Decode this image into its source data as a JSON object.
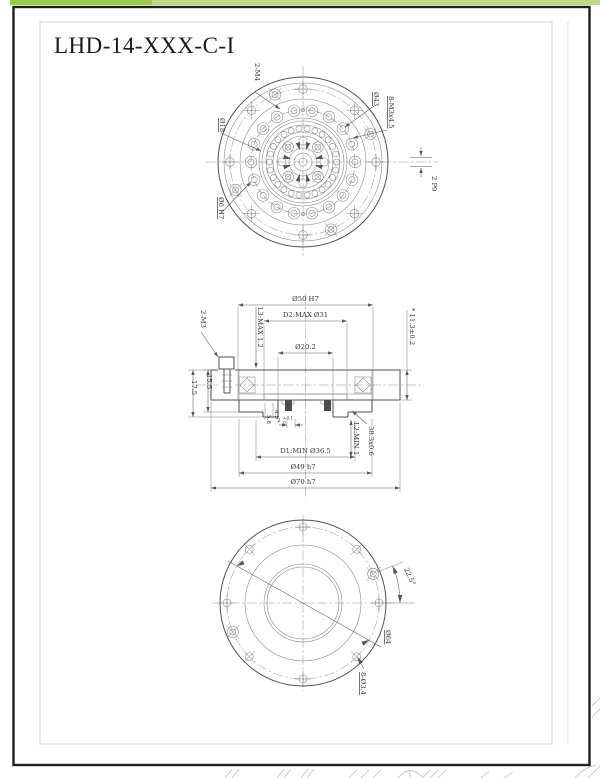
{
  "title": "LHD-14-XXX-C-I",
  "labels": {
    "tv_m4": "2-M4",
    "tv_d18": "Ø18",
    "tv_d6h7": "Ø6 H7",
    "tv_d43": "Ø43",
    "tv_m3x": "8-M3x4.5",
    "tv_key": "2 P9",
    "sv_m3": "2-M3",
    "sv_d50": "Ø50 H7",
    "sv_d2": "D2:MAX Ø31",
    "sv_d202": "Ø20.2",
    "sv_l3": "L3:MAX 1.2",
    "sv_h113": "* 11.3±0.2",
    "sv_155": "15.5",
    "sv_175": "17.5",
    "sv_58": "5.8",
    "sv_49": "4.9",
    "sv_2": "2",
    "sv_2u": "+0.1",
    "sv_2d": "0",
    "sv_d1": "D1:MIN Ø36.5",
    "sv_l2": "L2:MIN 1",
    "sv_ring": "38.3x0.6",
    "sv_d49": "Ø49 h7",
    "sv_d70": "Ø70 h7",
    "bv_angle": "22.5°",
    "bv_d64": "Ø64",
    "bv_holes": "8-Ø3.4"
  },
  "colors": {
    "accent_green_dark": "#9fc84f",
    "accent_green_light": "#bcd98b",
    "sheet_border": "#1f1f1f",
    "inner_frame": "#c9c9c9",
    "line": "#4f4f4f",
    "dim_line": "#5a5a5a",
    "text": "#333333",
    "background": "#ffffff"
  }
}
